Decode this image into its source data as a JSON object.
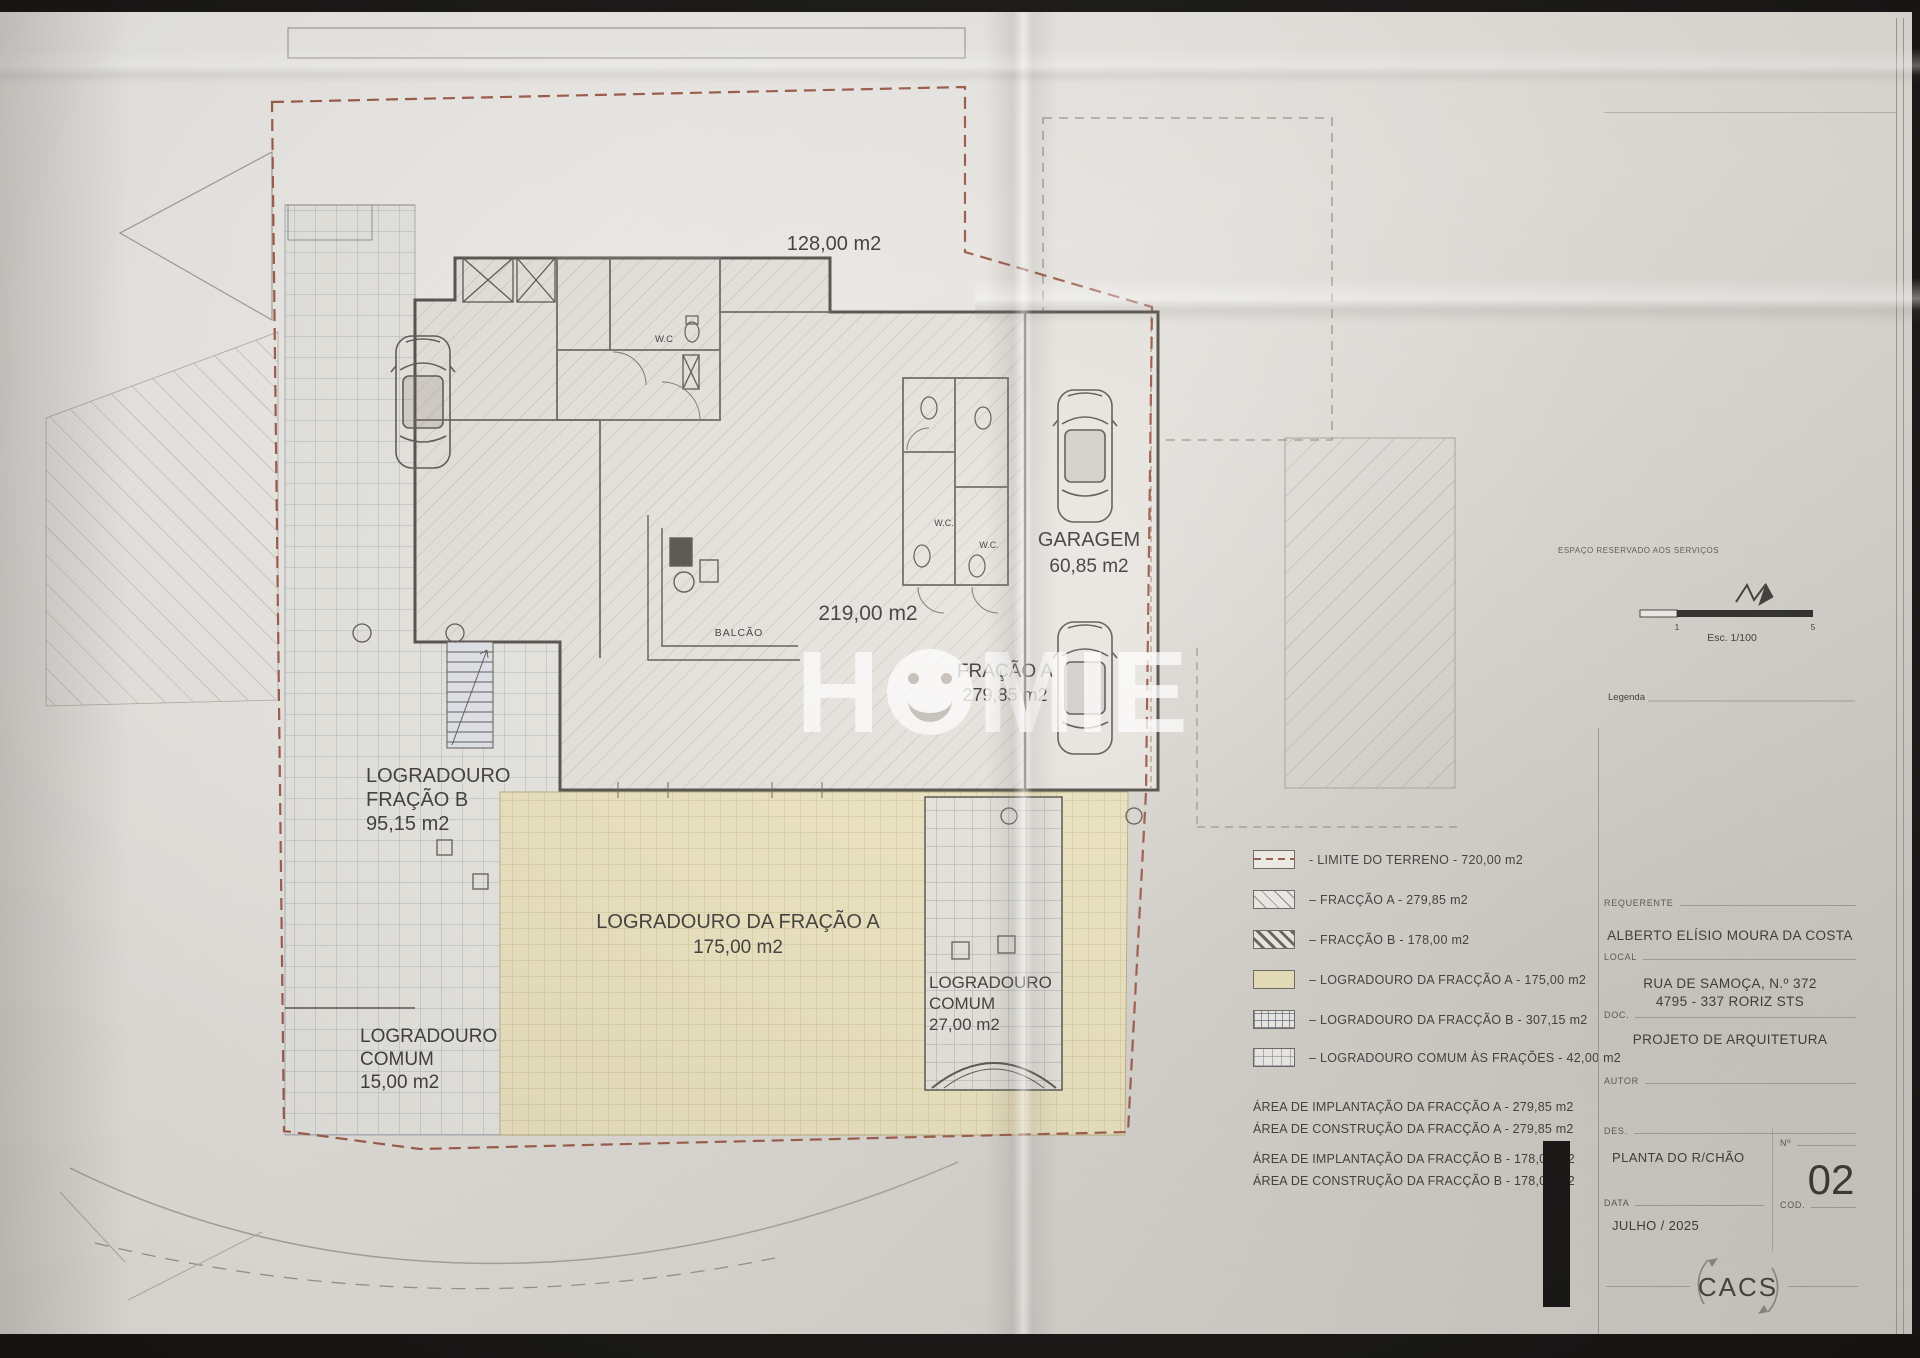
{
  "plan": {
    "top_area": "128,00 m2",
    "main_area": "219,00 m2",
    "balcao": "BALCÃO",
    "wc_top": "W.C",
    "wc_mid_a": "W.C.",
    "wc_mid_b": "W.C.",
    "garagem": {
      "name": "GARAGEM",
      "area": "60,85 m2"
    },
    "fracao_a": {
      "name": "FRAÇÃO A",
      "area": "279,85 m2"
    },
    "log_fracao_b": {
      "l1": "LOGRADOURO",
      "l2": "FRAÇÃO B",
      "l3": "95,15 m2"
    },
    "log_comum_left": {
      "l1": "LOGRADOURO",
      "l2": "COMUM",
      "l3": "15,00 m2"
    },
    "log_fracao_a": {
      "l1": "LOGRADOURO DA FRAÇÃO A",
      "l2": "175,00 m2"
    },
    "log_comum_right": {
      "l1": "LOGRADOURO",
      "l2": "COMUM",
      "l3": "27,00 m2"
    }
  },
  "watermark": {
    "left": "H",
    "right": "MIE"
  },
  "legend": {
    "items": [
      {
        "label": "- LIMITE DO TERRENO - 720,00 m2"
      },
      {
        "label": "–  FRACÇÃO A  - 279,85 m2"
      },
      {
        "label": "–  FRACÇÃO B  - 178,00 m2"
      },
      {
        "label": "–  LOGRADOURO DA FRACÇÃO A - 175,00 m2"
      },
      {
        "label": "–  LOGRADOURO DA FRACÇÃO B - 307,15 m2"
      },
      {
        "label": "–  LOGRADOURO COMUM ÀS FRAÇÕES  - 42,00 m2"
      }
    ],
    "areas": [
      "ÁREA DE IMPLANTAÇÃO DA FRACÇÃO A - 279,85 m2",
      "ÁREA DE CONSTRUÇÃO DA FRACÇÃO A - 279,85 m2",
      "ÁREA DE IMPLANTAÇÃO DA FRACÇÃO B - 178,00 m2",
      "ÁREA DE CONSTRUÇÃO DA FRACÇÃO B - 178,00 m2"
    ]
  },
  "titleblock": {
    "reserved_note": "ESPAÇO RESERVADO AOS SERVIÇOS",
    "scale": {
      "tick_start": "1",
      "tick_end": "5",
      "label": "Esc. 1/100"
    },
    "legenda_label": "Legenda",
    "requerente": {
      "label": "REQUERENTE",
      "value": "ALBERTO ELÍSIO MOURA DA COSTA"
    },
    "local": {
      "label": "LOCAL",
      "line1": "RUA DE SAMOÇA, N.º 372",
      "line2": "4795 - 337 RORIZ STS"
    },
    "doc": {
      "label": "DOC.",
      "value": "PROJETO DE ARQUITETURA"
    },
    "autor": {
      "label": "AUTOR"
    },
    "des": {
      "label": "DES.",
      "value": "PLANTA DO R/CHÃO"
    },
    "numero": {
      "label": "Nº",
      "value": "02"
    },
    "data": {
      "label": "DATA",
      "value": "JULHO / 2025"
    },
    "cod": {
      "label": "COD."
    },
    "stamp": "CACS"
  }
}
